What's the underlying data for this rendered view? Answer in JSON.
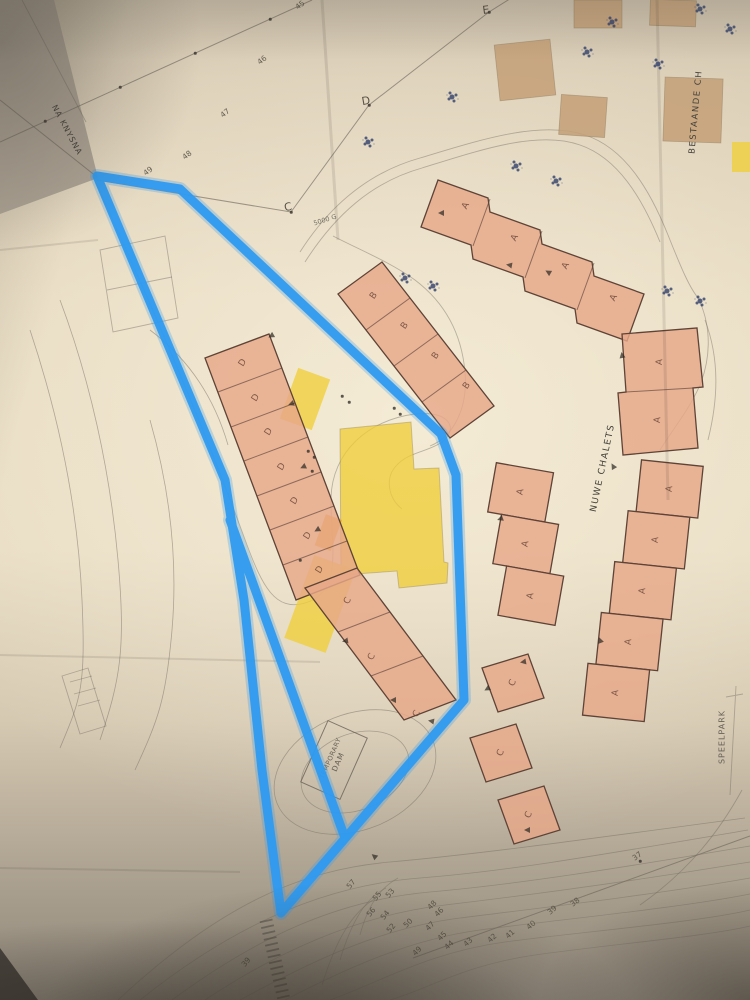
{
  "colors": {
    "blue": "#2e9af0",
    "bfill": "#e7a789",
    "bstroke": "#5e4337",
    "yellow": "#f0cd33",
    "orange": "#eda32a",
    "tan": "#c4a179",
    "pencil": "#6c6459",
    "tree": "#31406b",
    "ink": "#4a443b"
  },
  "labels": {
    "na_knysna": "NA KNYSNA",
    "bestaande": "BESTAANDE CH",
    "nuwe_chalets": "NUWE CHALETS",
    "speelpark": "SPEELPARK",
    "dam_line1": "TEMPORARY",
    "dam_line2": "DAM",
    "annotation_5000": "5000 G"
  },
  "map": {
    "route_letters": [
      {
        "v": "C",
        "x": 288,
        "y": 207,
        "r": -12
      },
      {
        "v": "D",
        "x": 366,
        "y": 101,
        "r": -10
      },
      {
        "v": "E",
        "x": 486,
        "y": 10,
        "r": -8
      }
    ],
    "unit_letters": [
      {
        "v": "A",
        "x": 466,
        "y": 206,
        "r": -62
      },
      {
        "v": "A",
        "x": 515,
        "y": 238,
        "r": -62
      },
      {
        "v": "A",
        "x": 566,
        "y": 266,
        "r": -62
      },
      {
        "v": "A",
        "x": 614,
        "y": 298,
        "r": -62
      },
      {
        "v": "A",
        "x": 660,
        "y": 362,
        "r": -85
      },
      {
        "v": "A",
        "x": 658,
        "y": 420,
        "r": -85
      },
      {
        "v": "A",
        "x": 670,
        "y": 489,
        "r": -84
      },
      {
        "v": "A",
        "x": 656,
        "y": 540,
        "r": -84
      },
      {
        "v": "A",
        "x": 643,
        "y": 591,
        "r": -84
      },
      {
        "v": "A",
        "x": 629,
        "y": 642,
        "r": -84
      },
      {
        "v": "A",
        "x": 616,
        "y": 693,
        "r": -84
      },
      {
        "v": "A",
        "x": 521,
        "y": 492,
        "r": -80
      },
      {
        "v": "A",
        "x": 526,
        "y": 544,
        "r": -80
      },
      {
        "v": "A",
        "x": 531,
        "y": 596,
        "r": -80
      },
      {
        "v": "C",
        "x": 513,
        "y": 683,
        "r": -65
      },
      {
        "v": "C",
        "x": 501,
        "y": 753,
        "r": -65
      },
      {
        "v": "C",
        "x": 529,
        "y": 815,
        "r": -65
      },
      {
        "v": "D",
        "x": 243,
        "y": 363,
        "r": -58
      },
      {
        "v": "D",
        "x": 256,
        "y": 398,
        "r": -58
      },
      {
        "v": "D",
        "x": 269,
        "y": 432,
        "r": -58
      },
      {
        "v": "D",
        "x": 282,
        "y": 467,
        "r": -58
      },
      {
        "v": "D",
        "x": 295,
        "y": 501,
        "r": -58
      },
      {
        "v": "D",
        "x": 308,
        "y": 536,
        "r": -58
      },
      {
        "v": "D",
        "x": 320,
        "y": 570,
        "r": -58
      },
      {
        "v": "B",
        "x": 374,
        "y": 296,
        "r": -55
      },
      {
        "v": "B",
        "x": 405,
        "y": 326,
        "r": -55
      },
      {
        "v": "B",
        "x": 436,
        "y": 356,
        "r": -55
      },
      {
        "v": "B",
        "x": 467,
        "y": 386,
        "r": -55
      },
      {
        "v": "C",
        "x": 348,
        "y": 601,
        "r": -60
      },
      {
        "v": "C",
        "x": 372,
        "y": 657,
        "r": -60
      },
      {
        "v": "C",
        "x": 417,
        "y": 714,
        "r": -60
      }
    ],
    "contour_labels_top": [
      {
        "v": "45",
        "x": 300,
        "y": 5,
        "r": -38
      },
      {
        "v": "46",
        "x": 262,
        "y": 60,
        "r": -38
      },
      {
        "v": "47",
        "x": 225,
        "y": 113,
        "r": -38
      },
      {
        "v": "48",
        "x": 187,
        "y": 155,
        "r": -38
      },
      {
        "v": "49",
        "x": 148,
        "y": 171,
        "r": -38
      }
    ],
    "contour_labels_bottom": [
      {
        "v": "57",
        "x": 351,
        "y": 884,
        "r": -50
      },
      {
        "v": "55",
        "x": 377,
        "y": 896,
        "r": -50
      },
      {
        "v": "53",
        "x": 390,
        "y": 893,
        "r": -50
      },
      {
        "v": "56",
        "x": 371,
        "y": 912,
        "r": -50
      },
      {
        "v": "54",
        "x": 385,
        "y": 915,
        "r": -50
      },
      {
        "v": "52",
        "x": 391,
        "y": 928,
        "r": -50
      },
      {
        "v": "50",
        "x": 408,
        "y": 923,
        "r": -45
      },
      {
        "v": "49",
        "x": 417,
        "y": 951,
        "r": -45
      },
      {
        "v": "48",
        "x": 432,
        "y": 905,
        "r": -45
      },
      {
        "v": "47",
        "x": 430,
        "y": 926,
        "r": -45
      },
      {
        "v": "46",
        "x": 439,
        "y": 912,
        "r": -45
      },
      {
        "v": "45",
        "x": 442,
        "y": 936,
        "r": -45
      },
      {
        "v": "44",
        "x": 449,
        "y": 945,
        "r": -42
      },
      {
        "v": "43",
        "x": 468,
        "y": 942,
        "r": -42
      },
      {
        "v": "42",
        "x": 492,
        "y": 938,
        "r": -42
      },
      {
        "v": "41",
        "x": 510,
        "y": 934,
        "r": -42
      },
      {
        "v": "40",
        "x": 531,
        "y": 925,
        "r": -40
      },
      {
        "v": "39",
        "x": 552,
        "y": 910,
        "r": -40
      },
      {
        "v": "38",
        "x": 575,
        "y": 902,
        "r": -38
      },
      {
        "v": "37",
        "x": 637,
        "y": 856,
        "r": -36
      },
      {
        "v": "39",
        "x": 246,
        "y": 962,
        "r": -50
      }
    ],
    "trees": [
      {
        "x": 587,
        "y": 52
      },
      {
        "x": 612,
        "y": 22
      },
      {
        "x": 700,
        "y": 9
      },
      {
        "x": 730,
        "y": 29
      },
      {
        "x": 658,
        "y": 64
      },
      {
        "x": 452,
        "y": 97
      },
      {
        "x": 516,
        "y": 166
      },
      {
        "x": 556,
        "y": 181
      },
      {
        "x": 405,
        "y": 278
      },
      {
        "x": 433,
        "y": 286
      },
      {
        "x": 667,
        "y": 291
      },
      {
        "x": 700,
        "y": 301
      },
      {
        "x": 368,
        "y": 142
      }
    ],
    "arrows": [
      {
        "x": 441,
        "y": 213,
        "r": 90
      },
      {
        "x": 509,
        "y": 265,
        "r": 100
      },
      {
        "x": 548,
        "y": 272,
        "r": 120
      },
      {
        "x": 271,
        "y": 336,
        "r": 60
      },
      {
        "x": 291,
        "y": 404,
        "r": 70
      },
      {
        "x": 303,
        "y": 467,
        "r": 65
      },
      {
        "x": 317,
        "y": 530,
        "r": 60
      },
      {
        "x": 345,
        "y": 641,
        "r": 80
      },
      {
        "x": 393,
        "y": 700,
        "r": 90
      },
      {
        "x": 431,
        "y": 721,
        "r": 100
      },
      {
        "x": 374,
        "y": 856,
        "r": 130
      },
      {
        "x": 523,
        "y": 662,
        "r": 80
      },
      {
        "x": 487,
        "y": 689,
        "r": 60
      },
      {
        "x": 527,
        "y": 830,
        "r": 90
      },
      {
        "x": 622,
        "y": 355,
        "r": 170
      },
      {
        "x": 613,
        "y": 466,
        "r": 150
      },
      {
        "x": 600,
        "y": 640,
        "r": 160
      },
      {
        "x": 500,
        "y": 519,
        "r": 70
      }
    ],
    "marks": [
      {
        "x": 342,
        "y": 396
      },
      {
        "x": 349,
        "y": 402
      },
      {
        "x": 308,
        "y": 451
      },
      {
        "x": 314,
        "y": 457
      },
      {
        "x": 312,
        "y": 471
      },
      {
        "x": 394,
        "y": 408
      },
      {
        "x": 400,
        "y": 414
      },
      {
        "x": 300,
        "y": 560
      },
      {
        "x": 291,
        "y": 212
      },
      {
        "x": 369,
        "y": 105
      },
      {
        "x": 489,
        "y": 12
      },
      {
        "x": 45,
        "y": 121
      },
      {
        "x": 120,
        "y": 87
      },
      {
        "x": 195,
        "y": 53
      },
      {
        "x": 270,
        "y": 19
      },
      {
        "x": 640,
        "y": 861
      }
    ]
  }
}
